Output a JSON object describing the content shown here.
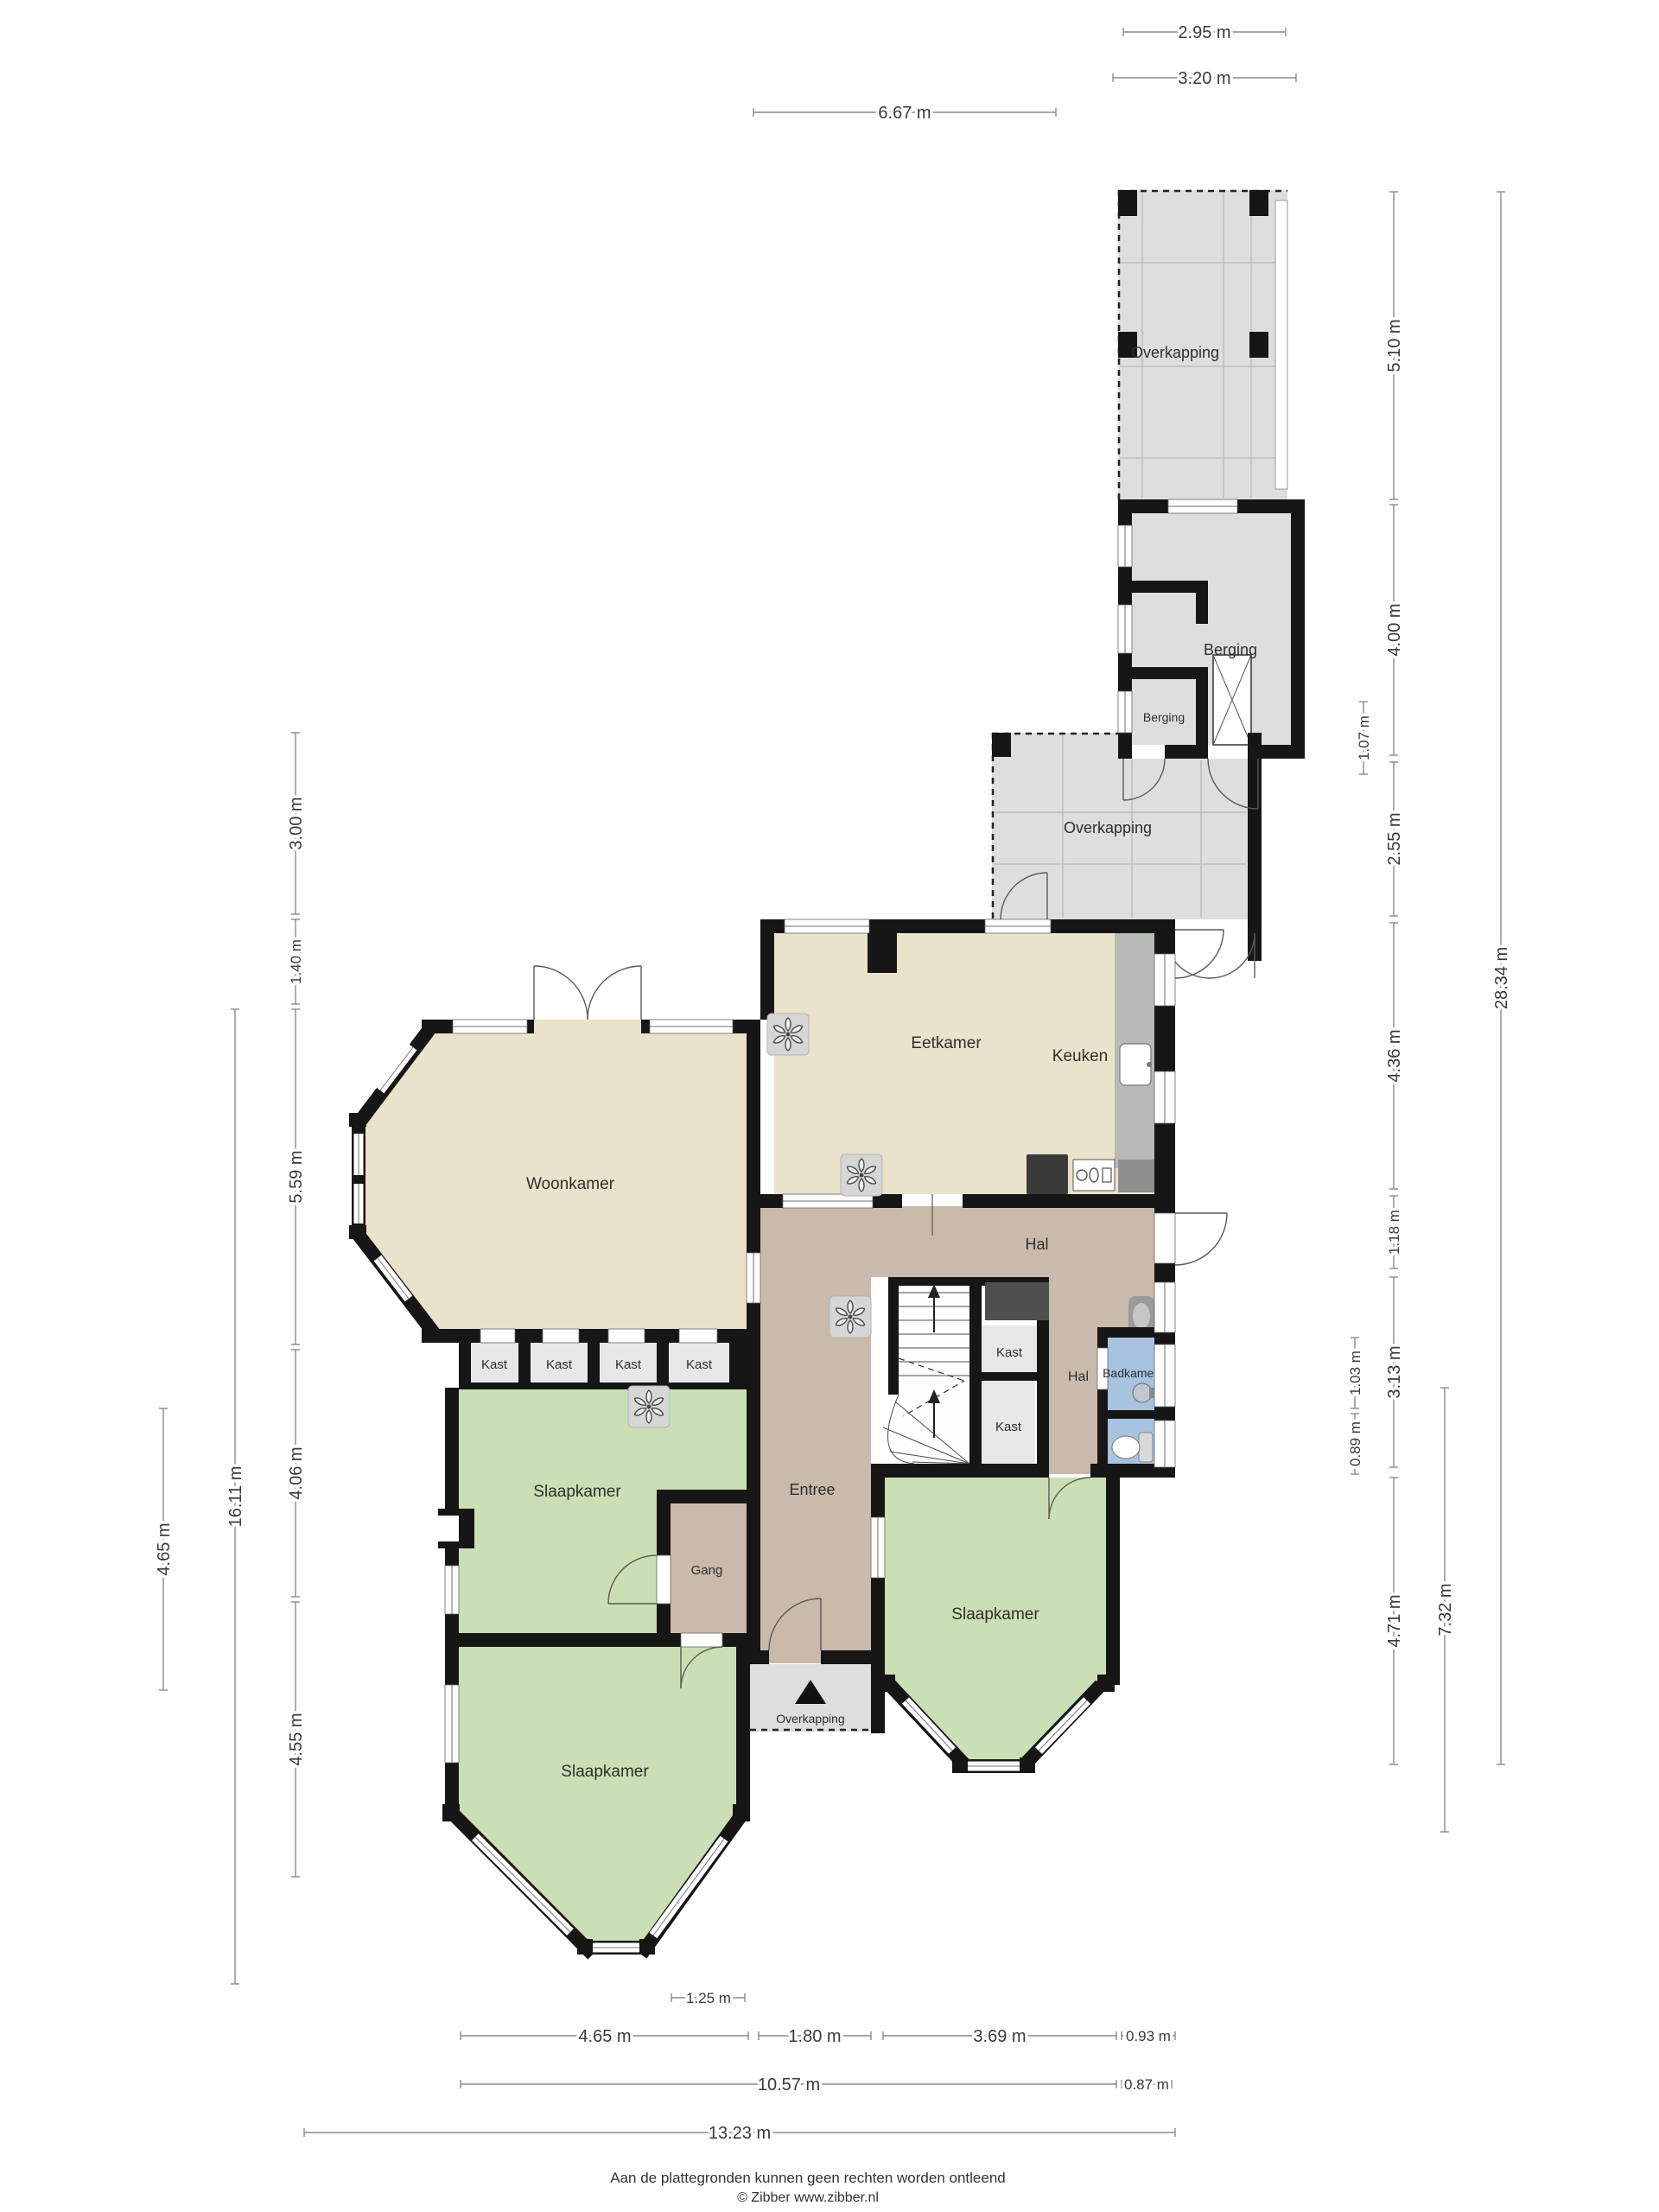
{
  "title": "Plattegrond begane grond",
  "rooms": {
    "overkapping_top": "Overkapping",
    "berging_large": "Berging",
    "berging_small": "Berging",
    "overkapping_mid": "Overkapping",
    "eetkamer": "Eetkamer",
    "keuken": "Keuken",
    "woonkamer": "Woonkamer",
    "hal_boven": "Hal",
    "kast_1": "Kast",
    "kast_2": "Kast",
    "kast_3": "Kast",
    "kast_4": "Kast",
    "slaapkamer_midden": "Slaapkamer",
    "kast_5": "Kast",
    "kast_6": "Kast",
    "hal_klein": "Hal",
    "badkamer": "Badkamer",
    "entree": "Entree",
    "gang": "Gang",
    "overkapping_entree": "Overkapping",
    "slaapkamer_onder": "Slaapkamer",
    "slaapkamer_rechts": "Slaapkamer"
  },
  "dimensions": {
    "top": [
      {
        "label": "2.95 m"
      },
      {
        "label": "3.20 m"
      },
      {
        "label": "6.67 m"
      }
    ],
    "right": [
      {
        "label": "5.10 m"
      },
      {
        "label": "4.00 m"
      },
      {
        "label": "1.07 m"
      },
      {
        "label": "2.55 m"
      },
      {
        "label": "4.36 m"
      },
      {
        "label": "1.18 m"
      },
      {
        "label": "3.13 m"
      },
      {
        "label": "1.03 m"
      },
      {
        "label": "0.89 m"
      },
      {
        "label": "4.71 m"
      },
      {
        "label": "7.32 m"
      },
      {
        "label": "28.34 m"
      }
    ],
    "left": [
      {
        "label": "3.00 m"
      },
      {
        "label": "1.40 m"
      },
      {
        "label": "5.59 m"
      },
      {
        "label": "4.06 m"
      },
      {
        "label": "4.55 m"
      },
      {
        "label": "16.11 m"
      },
      {
        "label": "4.65 m"
      }
    ],
    "bottom": [
      {
        "label": "1.25 m"
      },
      {
        "label": "4.65 m"
      },
      {
        "label": "1.80 m"
      },
      {
        "label": "3.69 m"
      },
      {
        "label": "0.93 m"
      },
      {
        "label": "10.57 m"
      },
      {
        "label": "0.87 m"
      },
      {
        "label": "13.23 m"
      }
    ]
  },
  "icons": {
    "fan_icon": "ceiling-fan",
    "north_triangle": "entrance-marker",
    "stair_arrow": "stairs-up-arrow"
  },
  "colors": {
    "wall": "#161616",
    "living_tan": "#EAE3CB",
    "bedroom_green": "#CBDFB5",
    "hall_brown": "#C9BAAB",
    "bath_blue": "#A8C3DF",
    "canopy_gray": "#DEDEDE",
    "closet_gray": "#E7E7E7",
    "counter_gray": "#B4BAB4",
    "dimension_gray": "#8A8A8A"
  },
  "footer": {
    "line1": "Aan de plattegronden kunnen geen rechten worden ontleend",
    "line2": "© Zibber www.zibber.nl"
  }
}
